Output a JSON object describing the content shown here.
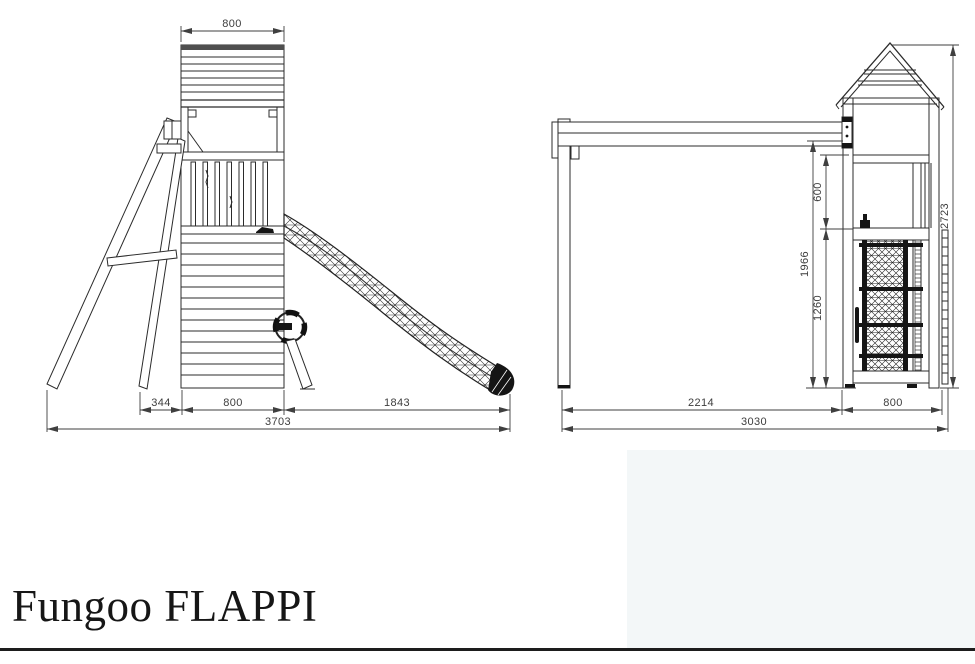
{
  "title": "Fungoo FLAPPI",
  "side_view": {
    "name": "Side view of tower with slide and access ladder",
    "dims": {
      "roof_width": "800",
      "ladder_span": "344",
      "tower_width": "800",
      "slide_span": "1843",
      "total_length": "3703"
    }
  },
  "front_view": {
    "name": "Front view of swing frame and tower with climbing net",
    "dims": {
      "swing_span": "2214",
      "tower_width": "800",
      "total_width": "3030",
      "beam_to_platform": "600",
      "platform_height": "1260",
      "frame_height": "1966",
      "total_height": "2723"
    }
  },
  "colors": {
    "line": "#2b2b2b",
    "dim_text": "#3d3d3d",
    "panel_tint": "#f3f7f8",
    "rule": "#1d1d1d",
    "background": "#ffffff"
  }
}
